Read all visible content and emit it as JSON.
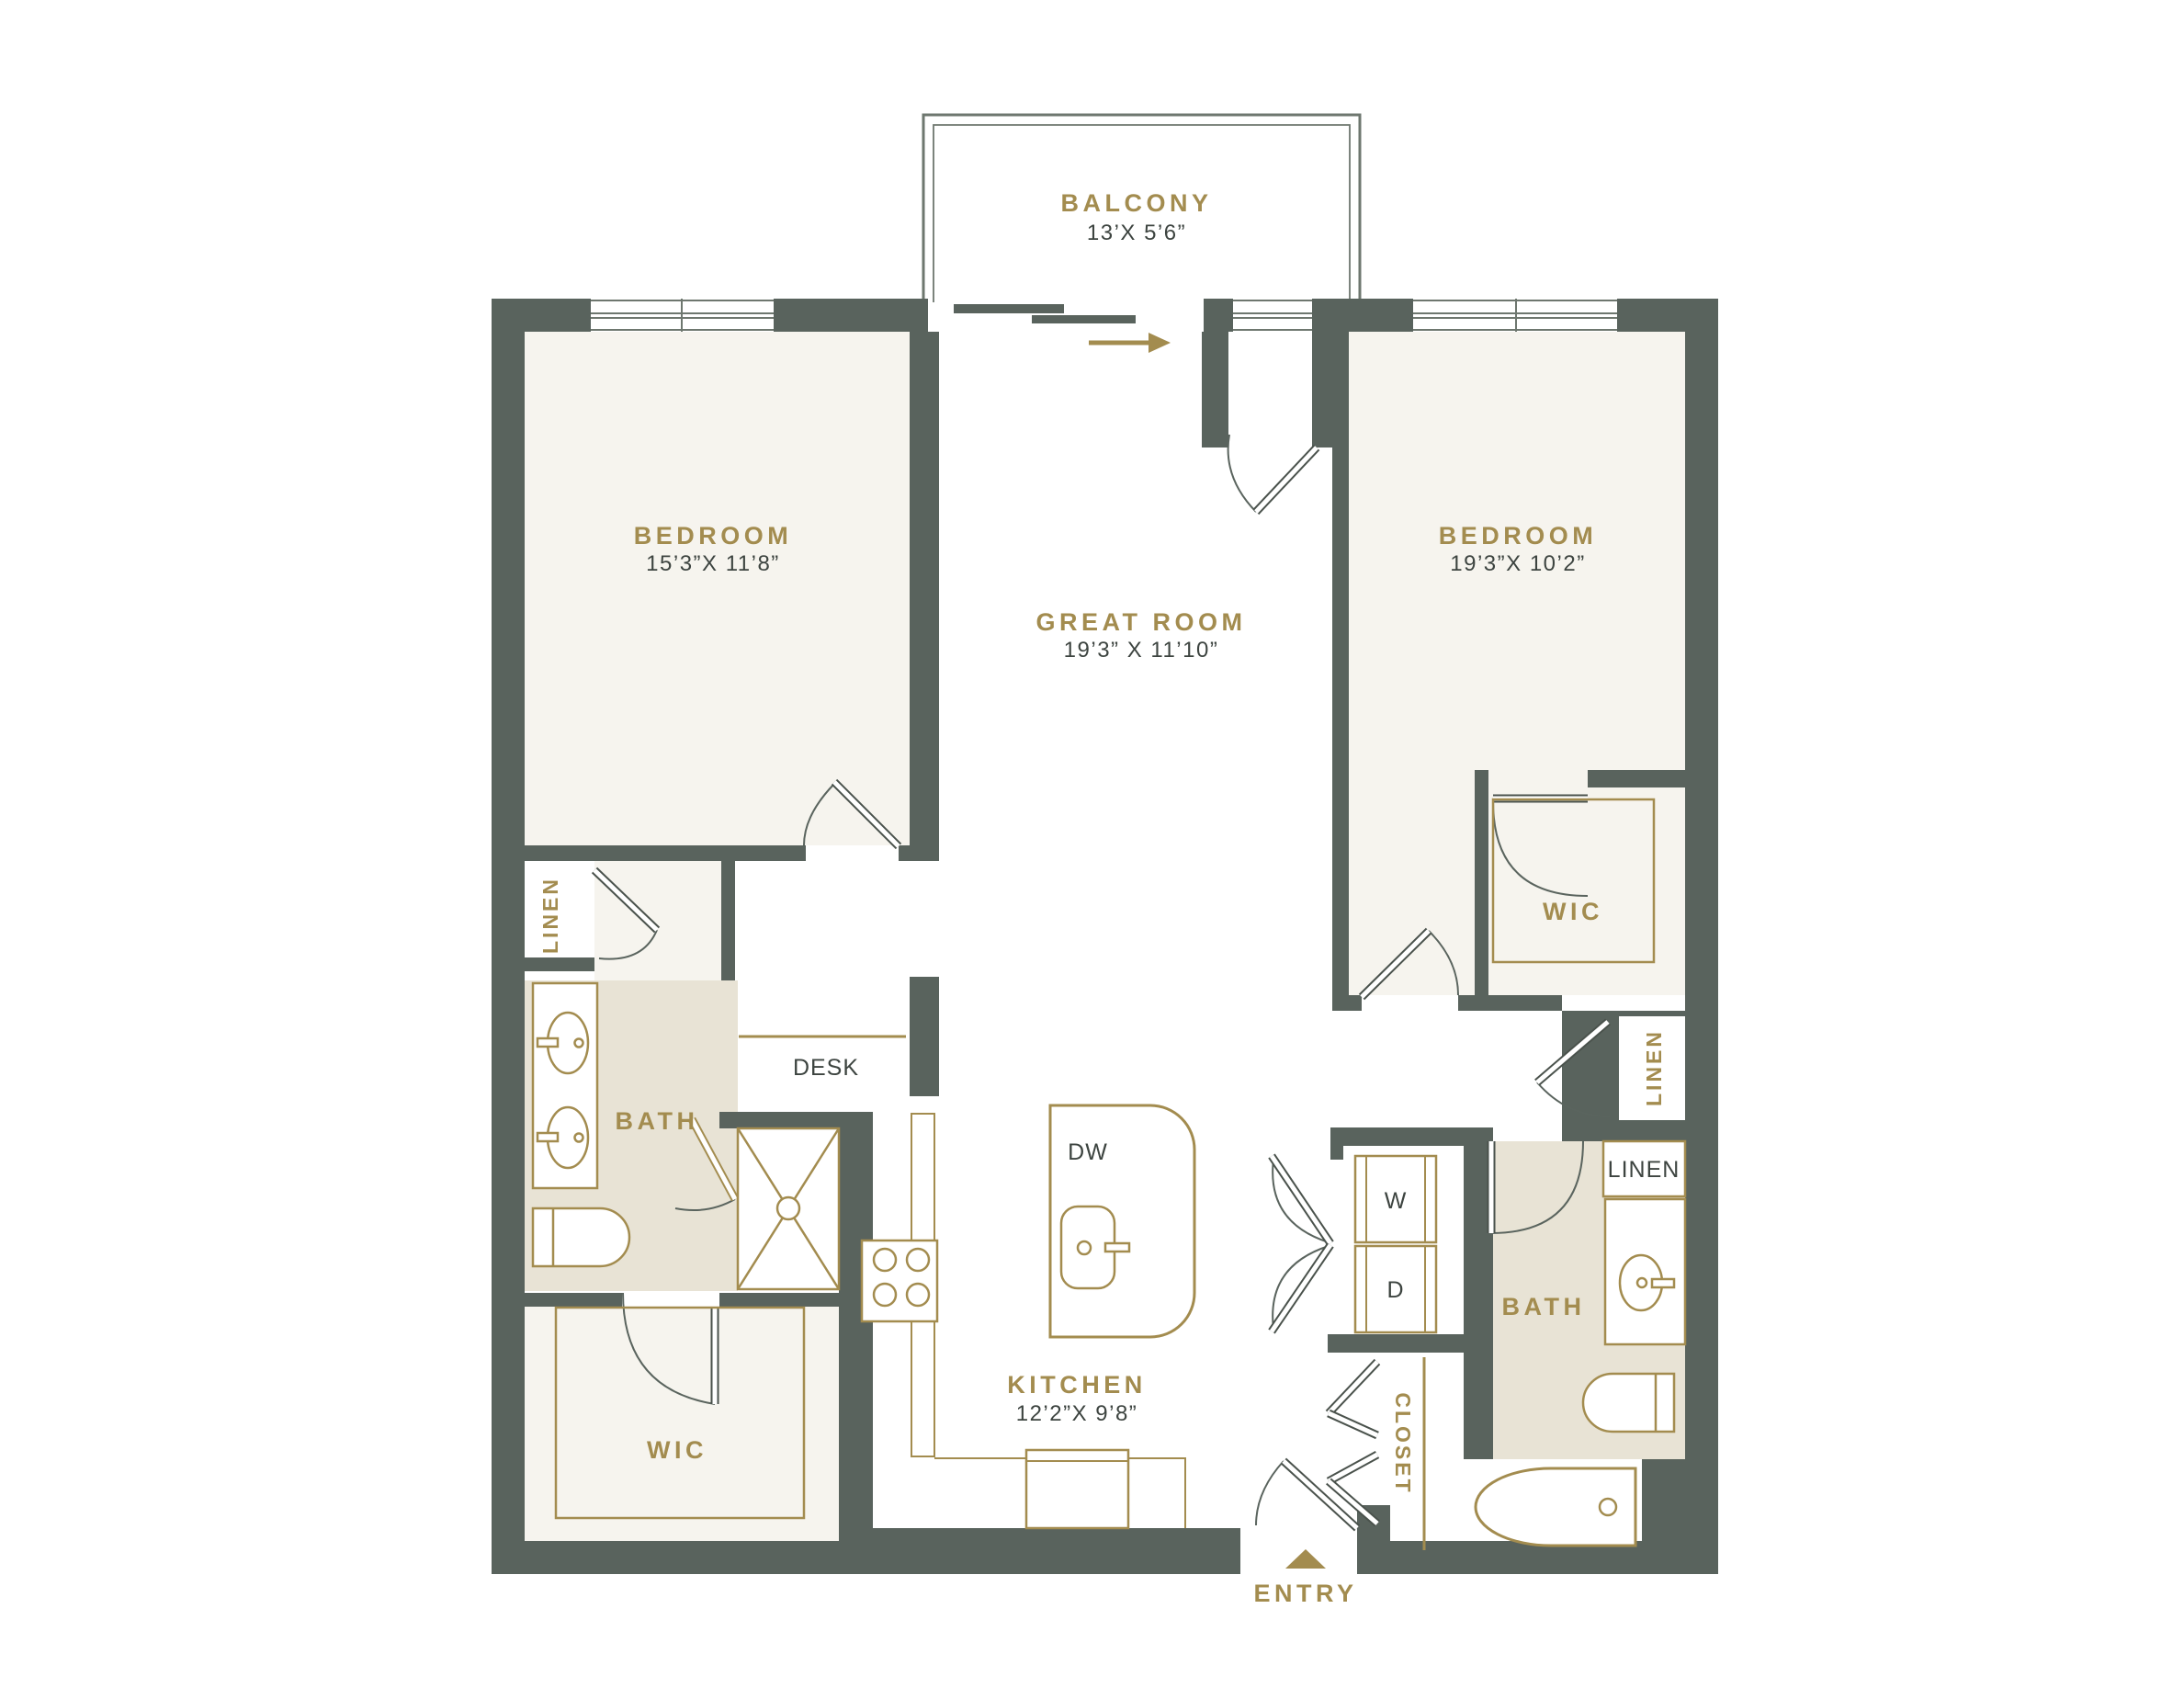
{
  "plan_title": "Two Bedroom Floor Plan",
  "colors": {
    "wall": "#59635d",
    "accent_gold": "#a38c4f",
    "room_cream": "#f6f4ee",
    "bath_beige": "#e8e3d5",
    "dim_text": "#3d4440",
    "window_line": "#6e776f"
  },
  "rooms": {
    "balcony": {
      "name": "BALCONY",
      "dims": "13’X 5’6”"
    },
    "bedroom_left": {
      "name": "BEDROOM",
      "dims": "15’3”X 11’8”"
    },
    "bedroom_right": {
      "name": "BEDROOM",
      "dims": "19’3”X 10’2”"
    },
    "great_room": {
      "name": "GREAT ROOM",
      "dims": "19’3” X 11’10”"
    },
    "kitchen": {
      "name": "KITCHEN",
      "dims": "12’2”X 9’8”"
    },
    "bath_left": {
      "name": "BATH"
    },
    "bath_right": {
      "name": "BATH"
    },
    "wic_left": {
      "name": "WIC"
    },
    "wic_right": {
      "name": "WIC"
    },
    "linen_left": {
      "name": "LINEN"
    },
    "linen_hall_right": {
      "name": "LINEN"
    },
    "linen_bath_right": {
      "name": "LINEN"
    },
    "closet": {
      "name": "CLOSET"
    },
    "desk": {
      "name": "DESK"
    }
  },
  "fixtures": {
    "dishwasher": "DW",
    "washer": "W",
    "dryer": "D"
  },
  "entry": {
    "label": "ENTRY"
  }
}
